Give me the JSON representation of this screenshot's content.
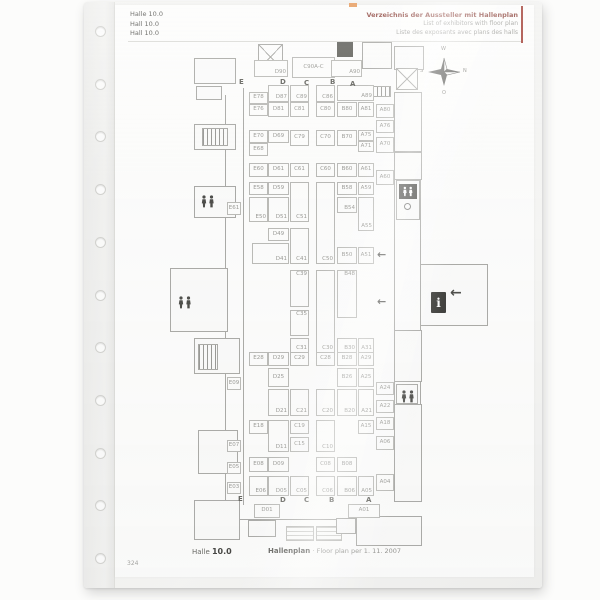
{
  "sleeve": {
    "hole_count": 11
  },
  "header": {
    "left": [
      "Halle 10.0",
      "Hall 10.0",
      "Hall 10.0"
    ],
    "right": [
      "Verzeichnis der Aussteller mit Hallenplan",
      "List of exhibitors with floor plan",
      "Liste des exposants avec plans des halls"
    ],
    "accent_color": "#8a4038"
  },
  "compass": {
    "top": "W",
    "right": "N",
    "bottom": "O",
    "left": "S"
  },
  "plan": {
    "column_letters_top": [
      "E",
      "D",
      "C",
      "B",
      "A"
    ],
    "column_letters_bottom": [
      "E",
      "D",
      "C",
      "B",
      "A"
    ],
    "letters": [
      [
        "E",
        239,
        78
      ],
      [
        "D",
        280,
        78
      ],
      [
        "C",
        304,
        79
      ],
      [
        "B",
        330,
        78
      ],
      [
        "A",
        350,
        80
      ],
      [
        "E",
        238,
        495
      ],
      [
        "D",
        280,
        496
      ],
      [
        "C",
        304,
        496
      ],
      [
        "B",
        329,
        496
      ],
      [
        "A",
        366,
        496
      ]
    ],
    "booths": [
      [
        "D90",
        254,
        60,
        34,
        17,
        "b"
      ],
      [
        "C90A-C",
        292,
        57,
        43,
        21,
        "c"
      ],
      [
        "A90",
        331,
        60,
        31,
        17,
        "b"
      ],
      [
        "E78",
        249,
        92,
        19,
        12,
        "c"
      ],
      [
        "E76",
        249,
        104,
        19,
        12,
        "c"
      ],
      [
        "D87",
        268,
        85,
        21,
        17,
        "b"
      ],
      [
        "D81",
        268,
        102,
        21,
        15,
        "c"
      ],
      [
        "C89",
        290,
        85,
        19,
        17,
        "b"
      ],
      [
        "C81",
        290,
        102,
        19,
        15,
        "c"
      ],
      [
        "C86",
        316,
        85,
        19,
        17,
        "b"
      ],
      [
        "C80",
        316,
        102,
        19,
        15,
        "c"
      ],
      [
        "A89",
        337,
        85,
        37,
        16,
        "b"
      ],
      [
        "B80",
        337,
        102,
        20,
        15,
        "c"
      ],
      [
        "A81",
        358,
        102,
        16,
        15,
        "c"
      ],
      [
        "A80",
        376,
        104,
        18,
        14,
        "c"
      ],
      [
        "A76",
        376,
        120,
        18,
        13,
        "c"
      ],
      [
        "E70",
        249,
        130,
        19,
        13,
        "c"
      ],
      [
        "E68",
        249,
        143,
        19,
        13,
        "c"
      ],
      [
        "D69",
        268,
        130,
        21,
        13,
        "c"
      ],
      [
        "C79",
        290,
        130,
        19,
        16,
        "c"
      ],
      [
        "C70",
        316,
        130,
        19,
        16,
        "c"
      ],
      [
        "B70",
        337,
        130,
        20,
        16,
        "c"
      ],
      [
        "A75",
        358,
        130,
        16,
        11,
        "c"
      ],
      [
        "A71",
        358,
        141,
        16,
        11,
        "c"
      ],
      [
        "A70",
        376,
        137,
        18,
        16,
        "c"
      ],
      [
        "E60",
        249,
        163,
        19,
        14,
        "c"
      ],
      [
        "D61",
        268,
        163,
        21,
        14,
        "c"
      ],
      [
        "C61",
        290,
        163,
        19,
        14,
        "c"
      ],
      [
        "C60",
        316,
        163,
        19,
        14,
        "c"
      ],
      [
        "B60",
        337,
        163,
        20,
        14,
        "c"
      ],
      [
        "A61",
        358,
        163,
        16,
        14,
        "c"
      ],
      [
        "A60",
        376,
        170,
        18,
        15,
        "c"
      ],
      [
        "E58",
        249,
        182,
        19,
        13,
        "c"
      ],
      [
        "D59",
        268,
        182,
        21,
        13,
        "c"
      ],
      [
        "B58",
        337,
        182,
        20,
        13,
        "c"
      ],
      [
        "A59",
        358,
        182,
        16,
        13,
        "c"
      ],
      [
        "B54",
        337,
        197,
        20,
        16,
        "b"
      ],
      [
        "A55",
        358,
        197,
        16,
        34,
        "b"
      ],
      [
        "E50",
        249,
        197,
        19,
        25,
        "b"
      ],
      [
        "D51",
        268,
        197,
        21,
        25,
        "b"
      ],
      [
        "C51",
        290,
        182,
        19,
        40,
        "b"
      ],
      [
        "C50",
        316,
        182,
        19,
        82,
        "b"
      ],
      [
        "D49",
        268,
        228,
        21,
        13,
        "c"
      ],
      [
        "D41",
        252,
        243,
        37,
        21,
        "b"
      ],
      [
        "C41",
        290,
        228,
        19,
        36,
        "b"
      ],
      [
        "B50",
        337,
        247,
        20,
        17,
        "c"
      ],
      [
        "A51",
        358,
        247,
        16,
        17,
        "c"
      ],
      [
        "C39",
        290,
        270,
        19,
        37,
        "t"
      ],
      [
        "C35",
        290,
        310,
        19,
        26,
        "t"
      ],
      [
        "C31",
        290,
        338,
        19,
        15,
        "b"
      ],
      [
        "C30",
        316,
        270,
        19,
        83,
        "b"
      ],
      [
        "B48",
        337,
        270,
        20,
        48,
        "t"
      ],
      [
        "B30",
        337,
        338,
        20,
        15,
        "b"
      ],
      [
        "A31",
        358,
        338,
        16,
        15,
        "b"
      ],
      [
        "E28",
        249,
        352,
        19,
        14,
        "c"
      ],
      [
        "D29",
        268,
        352,
        21,
        14,
        "c"
      ],
      [
        "C29",
        290,
        352,
        19,
        14,
        "c"
      ],
      [
        "C28",
        316,
        352,
        19,
        14,
        "c"
      ],
      [
        "B28",
        337,
        352,
        20,
        14,
        "c"
      ],
      [
        "A29",
        358,
        352,
        16,
        14,
        "c"
      ],
      [
        "D25",
        268,
        368,
        21,
        19,
        "c"
      ],
      [
        "B26",
        337,
        368,
        20,
        19,
        "c"
      ],
      [
        "A25",
        358,
        368,
        16,
        19,
        "c"
      ],
      [
        "D21",
        268,
        389,
        21,
        27,
        "b"
      ],
      [
        "C21",
        290,
        389,
        19,
        27,
        "b"
      ],
      [
        "C20",
        316,
        389,
        19,
        27,
        "b"
      ],
      [
        "B20",
        337,
        389,
        20,
        27,
        "b"
      ],
      [
        "A21",
        358,
        389,
        16,
        27,
        "b"
      ],
      [
        "A24",
        376,
        382,
        18,
        13,
        "c"
      ],
      [
        "A22",
        376,
        400,
        18,
        13,
        "c"
      ],
      [
        "E18",
        249,
        420,
        19,
        14,
        "c"
      ],
      [
        "C19",
        290,
        420,
        19,
        14,
        "c"
      ],
      [
        "A15",
        358,
        420,
        16,
        14,
        "c"
      ],
      [
        "A18",
        376,
        417,
        18,
        13,
        "c"
      ],
      [
        "D11",
        268,
        420,
        21,
        32,
        "b"
      ],
      [
        "C15",
        290,
        437,
        19,
        15,
        "c"
      ],
      [
        "C10",
        316,
        420,
        19,
        32,
        "b"
      ],
      [
        "A06",
        376,
        436,
        18,
        14,
        "c"
      ],
      [
        "E08",
        249,
        457,
        19,
        15,
        "c"
      ],
      [
        "D09",
        268,
        457,
        21,
        15,
        "c"
      ],
      [
        "C08",
        316,
        457,
        19,
        15,
        "c"
      ],
      [
        "B08",
        337,
        457,
        20,
        15,
        "c"
      ],
      [
        "E06",
        249,
        476,
        19,
        20,
        "b"
      ],
      [
        "D05",
        268,
        476,
        21,
        20,
        "b"
      ],
      [
        "C05",
        290,
        476,
        19,
        20,
        "b"
      ],
      [
        "C06",
        316,
        476,
        19,
        20,
        "b"
      ],
      [
        "B06",
        337,
        476,
        20,
        20,
        "b"
      ],
      [
        "A05",
        358,
        476,
        16,
        20,
        "b"
      ],
      [
        "A04",
        376,
        474,
        18,
        17,
        "c"
      ],
      [
        "E61",
        227,
        202,
        14,
        13,
        "c"
      ],
      [
        "E09",
        227,
        377,
        14,
        13,
        "c"
      ],
      [
        "E07",
        227,
        440,
        14,
        12,
        "c"
      ],
      [
        "E05",
        227,
        462,
        14,
        12,
        "c"
      ],
      [
        "E03",
        227,
        482,
        14,
        12,
        "c"
      ],
      [
        "D01",
        254,
        504,
        26,
        14,
        "c"
      ],
      [
        "A01",
        348,
        504,
        32,
        14,
        "c"
      ]
    ],
    "icons": {
      "wc": "restroom-pictogram",
      "info": "i",
      "entrance_arrow": "←"
    }
  },
  "footer": {
    "hall_word": "Halle",
    "hall_number": "10.0",
    "plan_word": "Hallenplan",
    "plan_rest": "· Floor plan per 1. 11. 2007",
    "page_number": "324"
  }
}
